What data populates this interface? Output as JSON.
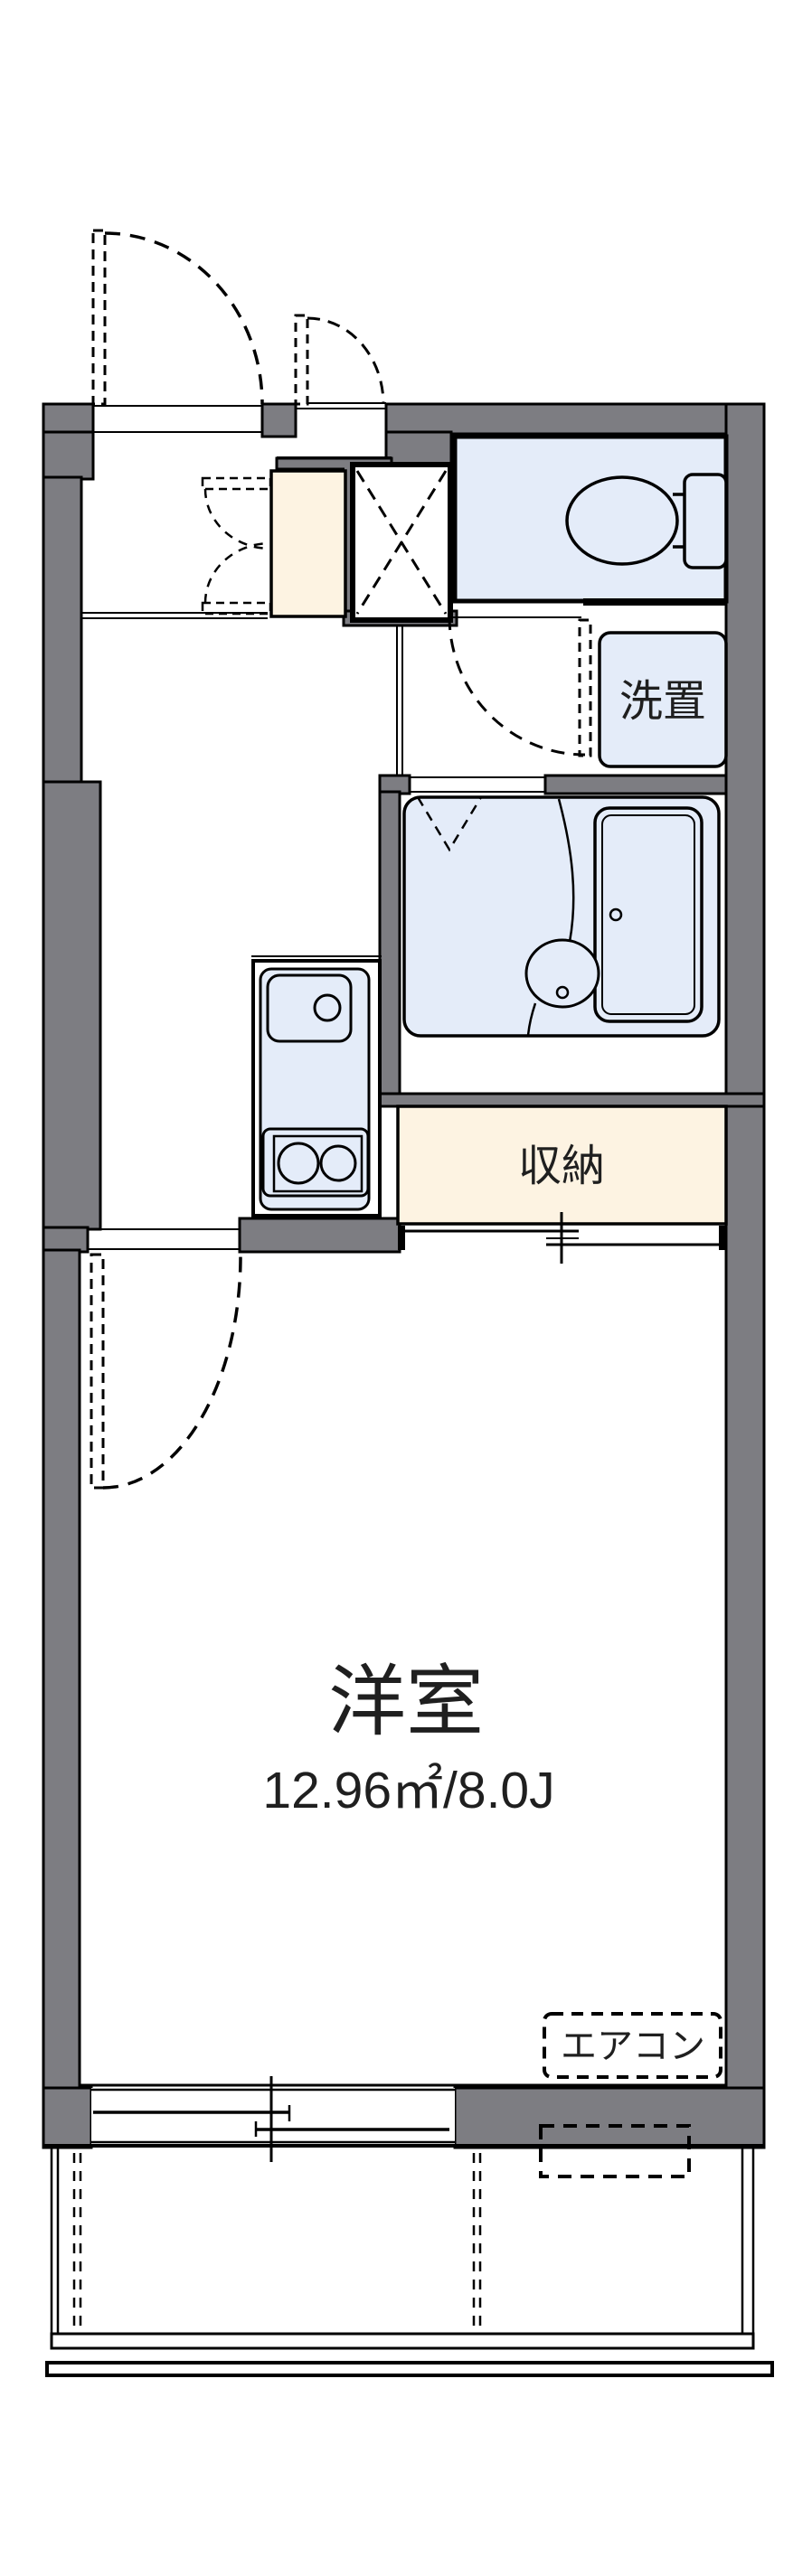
{
  "document": {
    "type": "apartment-floorplan"
  },
  "labels": {
    "laundry": "洗置",
    "storage": "収納",
    "room": "洋室",
    "room_area": "12.96㎡/8.0J",
    "aircon": "エアコン"
  },
  "colors": {
    "wall_gray": "#7d7d82",
    "wet_area_blue": "#e4ecf9",
    "entry_mat_cream": "#fdf3e2",
    "line_black": "#000000",
    "text_dark": "#1f1f1f"
  },
  "fixtures": [
    "toilet-icon",
    "washing-machine-space",
    "bathtub-icon",
    "washbasin-icon",
    "kitchen-sink-icon",
    "gas-stove-icon",
    "pipe-shaft-icon",
    "entrance-door-swing",
    "service-door-swing",
    "toilet-door-swing",
    "closet-double-door-swing",
    "room-door-swing",
    "storage-sliding-door",
    "balcony-sliding-window",
    "aircon-indoor-unit",
    "aircon-outdoor-unit"
  ]
}
